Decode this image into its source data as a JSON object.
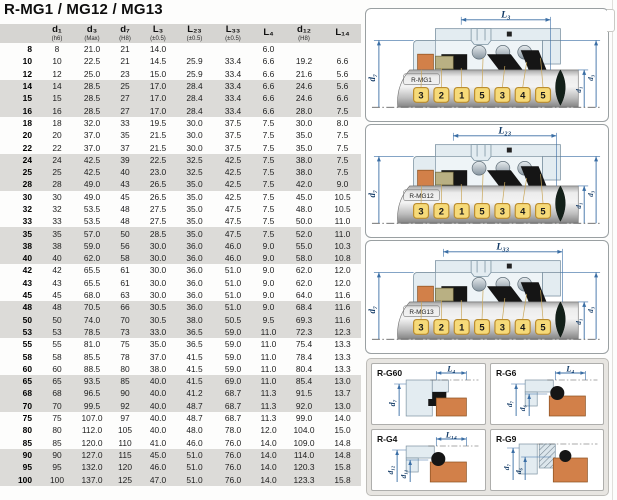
{
  "title": "R-MG1 / MG12 / MG13",
  "table": {
    "headers": [
      {
        "label": "",
        "tol": ""
      },
      {
        "label": "d₁",
        "tol": "(h6)"
      },
      {
        "label": "d₃",
        "tol": "(Max)"
      },
      {
        "label": "d₇",
        "tol": "(H8)"
      },
      {
        "label": "L₃",
        "tol": "(±0.5)"
      },
      {
        "label": "L₂₃",
        "tol": "(±0.5)"
      },
      {
        "label": "L₃₃",
        "tol": "(±0.5)"
      },
      {
        "label": "L₄",
        "tol": ""
      },
      {
        "label": "d₁₂",
        "tol": "(H8)"
      },
      {
        "label": "L₁₄",
        "tol": ""
      }
    ],
    "rows": [
      [
        "8",
        "8",
        "21.0",
        "21",
        "14.0",
        "",
        "",
        "6.0",
        "",
        ""
      ],
      [
        "10",
        "10",
        "22.5",
        "21",
        "14.5",
        "25.9",
        "33.4",
        "6.6",
        "19.2",
        "6.6"
      ],
      [
        "12",
        "12",
        "25.0",
        "23",
        "15.0",
        "25.9",
        "33.4",
        "6.6",
        "21.6",
        "5.6"
      ],
      [
        "14",
        "14",
        "28.5",
        "25",
        "17.0",
        "28.4",
        "33.4",
        "6.6",
        "24.6",
        "5.6"
      ],
      [
        "15",
        "15",
        "28.5",
        "27",
        "17.0",
        "28.4",
        "33.4",
        "6.6",
        "24.6",
        "6.6"
      ],
      [
        "16",
        "16",
        "28.5",
        "27",
        "17.0",
        "28.4",
        "33.4",
        "6.6",
        "28.0",
        "7.5"
      ],
      [
        "18",
        "18",
        "32.0",
        "33",
        "19.5",
        "30.0",
        "37.5",
        "7.5",
        "30.0",
        "8.0"
      ],
      [
        "20",
        "20",
        "37.0",
        "35",
        "21.5",
        "30.0",
        "37.5",
        "7.5",
        "35.0",
        "7.5"
      ],
      [
        "22",
        "22",
        "37.0",
        "37",
        "21.5",
        "30.0",
        "37.5",
        "7.5",
        "35.0",
        "7.5"
      ],
      [
        "24",
        "24",
        "42.5",
        "39",
        "22.5",
        "32.5",
        "42.5",
        "7.5",
        "38.0",
        "7.5"
      ],
      [
        "25",
        "25",
        "42.5",
        "40",
        "23.0",
        "32.5",
        "42.5",
        "7.5",
        "38.0",
        "7.5"
      ],
      [
        "28",
        "28",
        "49.0",
        "43",
        "26.5",
        "35.0",
        "42.5",
        "7.5",
        "42.0",
        "9.0"
      ],
      [
        "30",
        "30",
        "49.0",
        "45",
        "26.5",
        "35.0",
        "42.5",
        "7.5",
        "45.0",
        "10.5"
      ],
      [
        "32",
        "32",
        "53.5",
        "48",
        "27.5",
        "35.0",
        "47.5",
        "7.5",
        "48.0",
        "10.5"
      ],
      [
        "33",
        "33",
        "53.5",
        "48",
        "27.5",
        "35.0",
        "47.5",
        "7.5",
        "50.0",
        "11.0"
      ],
      [
        "35",
        "35",
        "57.0",
        "50",
        "28.5",
        "35.0",
        "47.5",
        "7.5",
        "52.0",
        "11.0"
      ],
      [
        "38",
        "38",
        "59.0",
        "56",
        "30.0",
        "36.0",
        "46.0",
        "9.0",
        "55.0",
        "10.3"
      ],
      [
        "40",
        "40",
        "62.0",
        "58",
        "30.0",
        "36.0",
        "46.0",
        "9.0",
        "58.0",
        "10.8"
      ],
      [
        "42",
        "42",
        "65.5",
        "61",
        "30.0",
        "36.0",
        "51.0",
        "9.0",
        "62.0",
        "12.0"
      ],
      [
        "43",
        "43",
        "65.5",
        "61",
        "30.0",
        "36.0",
        "51.0",
        "9.0",
        "62.0",
        "12.0"
      ],
      [
        "45",
        "45",
        "68.0",
        "63",
        "30.0",
        "36.0",
        "51.0",
        "9.0",
        "64.0",
        "11.6"
      ],
      [
        "48",
        "48",
        "70.5",
        "66",
        "30.5",
        "36.0",
        "51.0",
        "9.0",
        "68.4",
        "11.6"
      ],
      [
        "50",
        "50",
        "74.0",
        "70",
        "30.5",
        "38.0",
        "50.5",
        "9.5",
        "69.3",
        "11.6"
      ],
      [
        "53",
        "53",
        "78.5",
        "73",
        "33.0",
        "36.5",
        "59.0",
        "11.0",
        "72.3",
        "12.3"
      ],
      [
        "55",
        "55",
        "81.0",
        "75",
        "35.0",
        "36.5",
        "59.0",
        "11.0",
        "75.4",
        "13.3"
      ],
      [
        "58",
        "58",
        "85.5",
        "78",
        "37.0",
        "41.5",
        "59.0",
        "11.0",
        "78.4",
        "13.3"
      ],
      [
        "60",
        "60",
        "88.5",
        "80",
        "38.0",
        "41.5",
        "59.0",
        "11.0",
        "80.4",
        "13.3"
      ],
      [
        "65",
        "65",
        "93.5",
        "85",
        "40.0",
        "41.5",
        "69.0",
        "11.0",
        "85.4",
        "13.0"
      ],
      [
        "68",
        "68",
        "96.5",
        "90",
        "40.0",
        "41.2",
        "68.7",
        "11.3",
        "91.5",
        "13.7"
      ],
      [
        "70",
        "70",
        "99.5",
        "92",
        "40.0",
        "48.7",
        "68.7",
        "11.3",
        "92.0",
        "13.0"
      ],
      [
        "75",
        "75",
        "107.0",
        "97",
        "40.0",
        "48.7",
        "68.7",
        "11.3",
        "99.0",
        "14.0"
      ],
      [
        "80",
        "80",
        "112.0",
        "105",
        "40.0",
        "48.0",
        "78.0",
        "12.0",
        "104.0",
        "15.0"
      ],
      [
        "85",
        "85",
        "120.0",
        "110",
        "41.0",
        "46.0",
        "76.0",
        "14.0",
        "109.0",
        "14.8"
      ],
      [
        "90",
        "90",
        "127.0",
        "115",
        "45.0",
        "51.0",
        "76.0",
        "14.0",
        "114.0",
        "14.8"
      ],
      [
        "95",
        "95",
        "132.0",
        "120",
        "46.0",
        "51.0",
        "76.0",
        "14.0",
        "120.3",
        "15.8"
      ],
      [
        "100",
        "100",
        "137.0",
        "125",
        "47.0",
        "51.0",
        "76.0",
        "14.0",
        "123.3",
        "15.8"
      ]
    ]
  },
  "diagrams": [
    {
      "label": "R-MG1",
      "top_dim": "L₃",
      "left_dim": "d₇",
      "right_dims": [
        "d₁",
        "d₃"
      ],
      "chips": [
        "3",
        "2",
        "1",
        "5",
        "3",
        "4",
        "5"
      ]
    },
    {
      "label": "R-MG12",
      "top_dim": "L₂₃",
      "left_dim": "d₇",
      "right_dims": [
        "d₁",
        "d₃"
      ],
      "chips": [
        "3",
        "2",
        "1",
        "5",
        "3",
        "4",
        "5"
      ]
    },
    {
      "label": "R-MG13",
      "top_dim": "L₃₃",
      "left_dim": "d₇",
      "right_dims": [
        "d₁",
        "d₃"
      ],
      "chips": [
        "3",
        "2",
        "1",
        "5",
        "3",
        "4",
        "5"
      ]
    }
  ],
  "sections": [
    {
      "label": "R-G60",
      "top_dim": "L₄",
      "left_dims": [
        "d₇"
      ]
    },
    {
      "label": "R-G6",
      "top_dim": "L₄",
      "left_dims": [
        "d₇",
        "d₆"
      ]
    },
    {
      "label": "R-G4",
      "top_dim": "L₁₄",
      "left_dims": [
        "d₁₂",
        "d₁₁"
      ]
    },
    {
      "label": "R-G9",
      "top_dim": "",
      "left_dims": [
        "d₇",
        "d₆"
      ]
    }
  ],
  "colors": {
    "dim_blue": "#3a6ea5",
    "chip_yellow": "#f6da79",
    "chip_border": "#bb8d2f",
    "seat_orange": "#d28049",
    "ring_tan": "#b9b083",
    "elastomer_black": "#151515",
    "bellows_dark": "#132019",
    "housing_light": "#e3ecf1",
    "housing_stroke": "#7d93a2",
    "stripe_gray": "#dcdbd8",
    "header_gray": "#d6d5d2"
  }
}
